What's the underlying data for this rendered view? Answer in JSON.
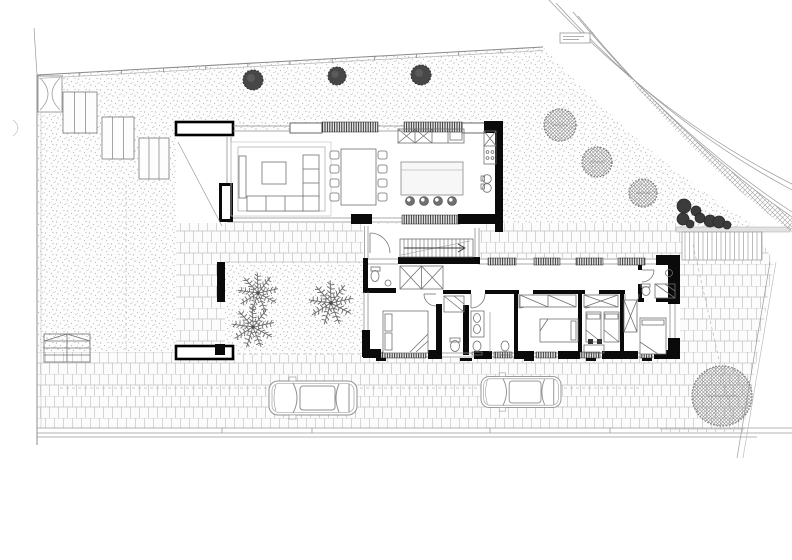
{
  "palette": {
    "paper": "#ffffff",
    "wall_black": "#0a0a0a",
    "line_gray": "#8f8f8f",
    "brick_joint": "#bdbdbd",
    "stipple_dot": "#b1b1b1",
    "dark_tree": "#474747",
    "hatched_tree_line": "#8d8d8d",
    "shrub": "#3b3b3b"
  },
  "vegetation": {
    "dark_trees": [
      {
        "cx": 253,
        "cy": 80,
        "r": 10
      },
      {
        "cx": 337,
        "cy": 76,
        "r": 9
      },
      {
        "cx": 421,
        "cy": 75,
        "r": 10
      }
    ],
    "hatched_trees": [
      {
        "cx": 560,
        "cy": 125,
        "r": 16
      },
      {
        "cx": 597,
        "cy": 162,
        "r": 15
      },
      {
        "cx": 643,
        "cy": 193,
        "r": 14
      },
      {
        "cx": 722,
        "cy": 396,
        "r": 30
      }
    ],
    "shrubs": [
      {
        "cx": 684,
        "cy": 206,
        "r": 7
      },
      {
        "cx": 696,
        "cy": 211,
        "r": 5
      },
      {
        "cx": 683,
        "cy": 219,
        "r": 6
      },
      {
        "cx": 700,
        "cy": 218,
        "r": 5
      },
      {
        "cx": 710,
        "cy": 221,
        "r": 6
      },
      {
        "cx": 719,
        "cy": 222,
        "r": 6
      },
      {
        "cx": 727,
        "cy": 225,
        "r": 4
      },
      {
        "cx": 690,
        "cy": 224,
        "r": 4
      }
    ],
    "palms": [
      {
        "cx": 258,
        "cy": 293,
        "r": 21
      },
      {
        "cx": 253,
        "cy": 327,
        "r": 22
      },
      {
        "cx": 331,
        "cy": 303,
        "r": 23
      }
    ]
  },
  "vehicles": {
    "cars": [
      {
        "cx": 313,
        "cy": 398,
        "len": 88
      },
      {
        "cx": 521,
        "cy": 392,
        "len": 80
      }
    ]
  },
  "structures": {
    "planters": [
      {
        "x": 63,
        "y": 92,
        "w": 34,
        "h": 41,
        "slats": 3
      },
      {
        "x": 102,
        "y": 117,
        "w": 32,
        "h": 42,
        "slats": 3
      },
      {
        "x": 139,
        "y": 138,
        "w": 30,
        "h": 41,
        "slats": 3
      }
    ],
    "fence": {
      "x1": 37,
      "y1": 75,
      "x2": 543,
      "y2": 47,
      "tick_count": 12
    },
    "sidewalk": {
      "lines": [
        [
          37,
          428,
          792,
          428
        ],
        [
          37,
          433,
          792,
          433
        ],
        [
          37,
          437,
          757,
          437
        ]
      ],
      "ticks": [
        222,
        312,
        490,
        610
      ]
    },
    "dashed_lines": [
      [
        126,
        185,
        126,
        350
      ],
      [
        225,
        354,
        363,
        354
      ],
      [
        693,
        245,
        735,
        430
      ],
      [
        60,
        388,
        640,
        388
      ]
    ]
  },
  "rooms": [
    {
      "id": "living-room",
      "x": 233,
      "y": 137,
      "w": 160,
      "h": 85
    },
    {
      "id": "dining-area",
      "x": 330,
      "y": 140,
      "w": 60,
      "h": 75
    },
    {
      "id": "kitchen",
      "x": 395,
      "y": 133,
      "w": 105,
      "h": 90
    },
    {
      "id": "entry-path",
      "x": 176,
      "y": 137,
      "w": 49,
      "h": 215
    },
    {
      "id": "courtyard",
      "x": 225,
      "y": 262,
      "w": 140,
      "h": 92
    },
    {
      "id": "hallway-stairs",
      "x": 363,
      "y": 226,
      "w": 117,
      "h": 36
    },
    {
      "id": "wc",
      "x": 365,
      "y": 262,
      "w": 30,
      "h": 28
    },
    {
      "id": "corridor",
      "x": 443,
      "y": 265,
      "w": 197,
      "h": 25
    },
    {
      "id": "master-bedroom",
      "x": 365,
      "y": 292,
      "w": 71,
      "h": 63
    },
    {
      "id": "bathroom-1",
      "x": 443,
      "y": 292,
      "w": 26,
      "h": 63
    },
    {
      "id": "bathroom-2",
      "x": 470,
      "y": 292,
      "w": 44,
      "h": 63
    },
    {
      "id": "bedroom-2",
      "x": 518,
      "y": 292,
      "w": 60,
      "h": 63
    },
    {
      "id": "bedroom-3",
      "x": 582,
      "y": 292,
      "w": 38,
      "h": 63
    },
    {
      "id": "bedroom-4",
      "x": 624,
      "y": 292,
      "w": 44,
      "h": 63
    },
    {
      "id": "ensuite-bathroom",
      "x": 642,
      "y": 265,
      "w": 36,
      "h": 35
    },
    {
      "id": "garden-north",
      "x": 40,
      "y": 50,
      "w": 500,
      "h": 75
    },
    {
      "id": "garden-west",
      "x": 40,
      "y": 130,
      "w": 136,
      "h": 220
    },
    {
      "id": "garden-east",
      "x": 505,
      "y": 55,
      "w": 250,
      "h": 170
    },
    {
      "id": "patio",
      "x": 225,
      "y": 223,
      "w": 455,
      "h": 39
    },
    {
      "id": "driveway",
      "x": 40,
      "y": 352,
      "w": 700,
      "h": 78
    },
    {
      "id": "side-yard-east",
      "x": 660,
      "y": 230,
      "w": 115,
      "h": 205
    }
  ]
}
